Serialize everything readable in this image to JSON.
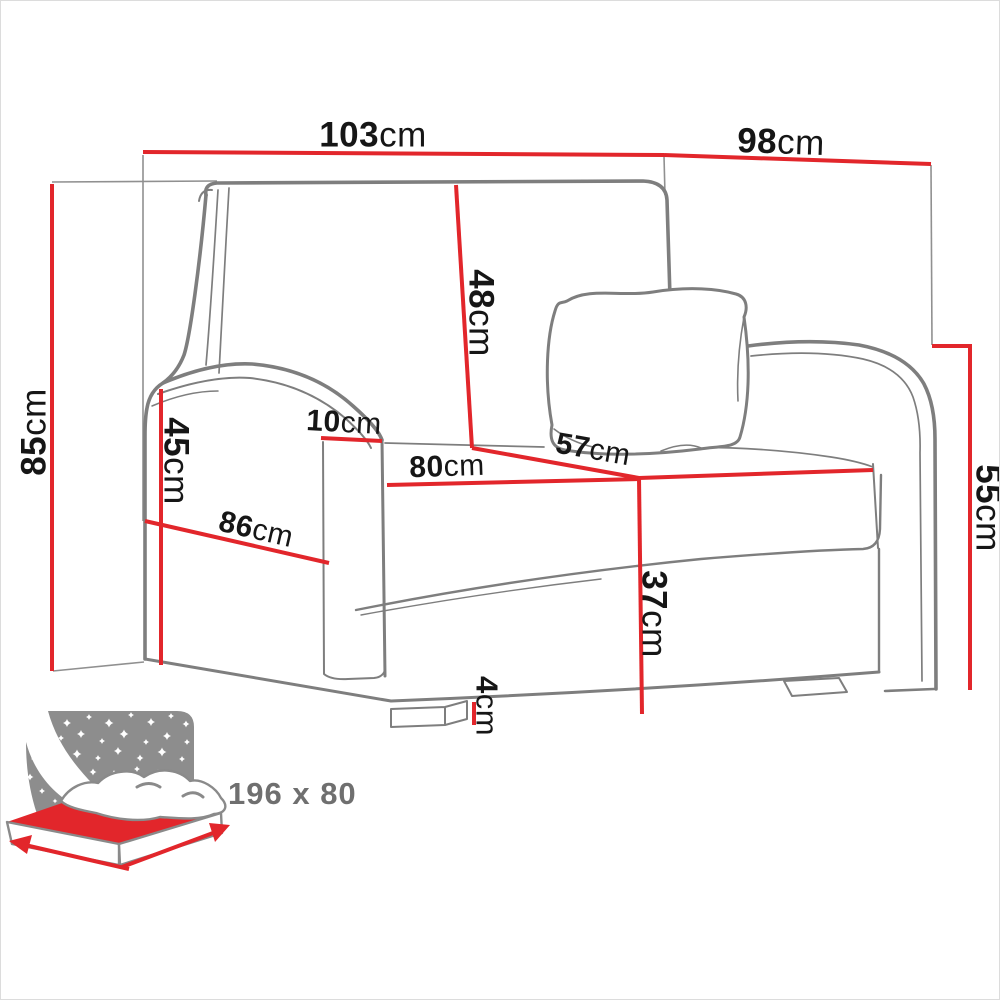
{
  "page": {
    "title": "Armchair sofa bed dimensions diagram"
  },
  "colors": {
    "dimension_red": "#e2262b",
    "sketch_gray": "#7e7e7e",
    "panel_gray": "#8d8d8d",
    "label_black": "#161616",
    "bed_label_gray": "#6f6f6f"
  },
  "measurements": {
    "total_width": {
      "value": "103",
      "unit": "cm"
    },
    "side_width": {
      "value": "98",
      "unit": "cm"
    },
    "total_height": {
      "value": "85",
      "unit": "cm"
    },
    "backrest_height": {
      "value": "48",
      "unit": "cm"
    },
    "left_armrest_height": {
      "value": "45",
      "unit": "cm"
    },
    "armrest_thickness": {
      "value": "10",
      "unit": "cm"
    },
    "seat_width": {
      "value": "80",
      "unit": "cm"
    },
    "seat_depth": {
      "value": "57",
      "unit": "cm"
    },
    "side_depth": {
      "value": "86",
      "unit": "cm"
    },
    "right_armrest_height": {
      "value": "55",
      "unit": "cm"
    },
    "seat_height": {
      "value": "37",
      "unit": "cm"
    },
    "foot_height": {
      "value": "4",
      "unit": "cm"
    }
  },
  "bed_icon": {
    "sleeping_area": "196 x 80"
  }
}
